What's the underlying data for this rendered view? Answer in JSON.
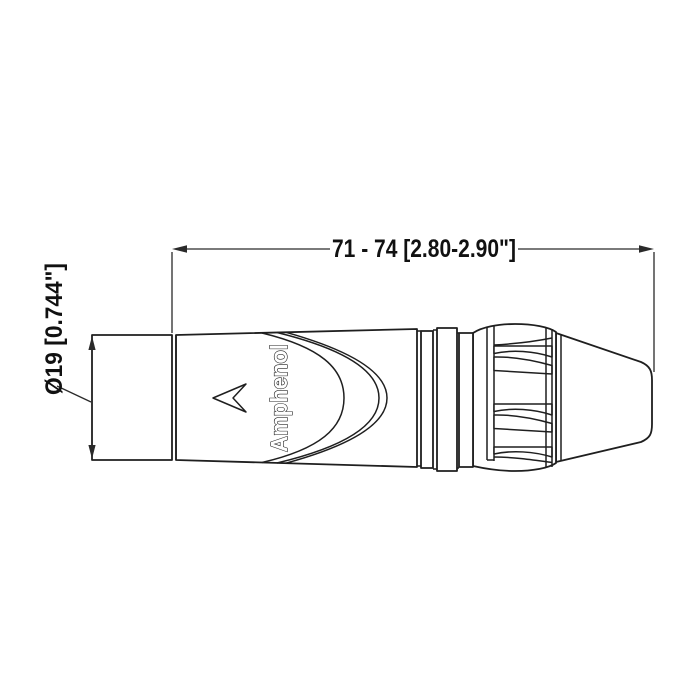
{
  "page": {
    "background": "#ffffff",
    "line_color": "#1f1f1f",
    "dimension_color": "#2a2a2a"
  },
  "drawing": {
    "type": "technical-dimension-drawing",
    "subject": "Amphenol XLR cable connector, side view",
    "dimensions": {
      "overall_length": {
        "label": "71 - 74 [2.80-2.90\"]",
        "value_mm": "71 - 74",
        "value_in": "2.80-2.90\""
      },
      "barrel_diameter": {
        "label": "Ø19 [0.744\"]",
        "value_mm": "Ø19",
        "value_in": "0.744\""
      }
    },
    "branding": {
      "logo_text": "Amphenol"
    },
    "icons": {
      "orientation_arrow": "left-chevron-outline-icon"
    }
  }
}
